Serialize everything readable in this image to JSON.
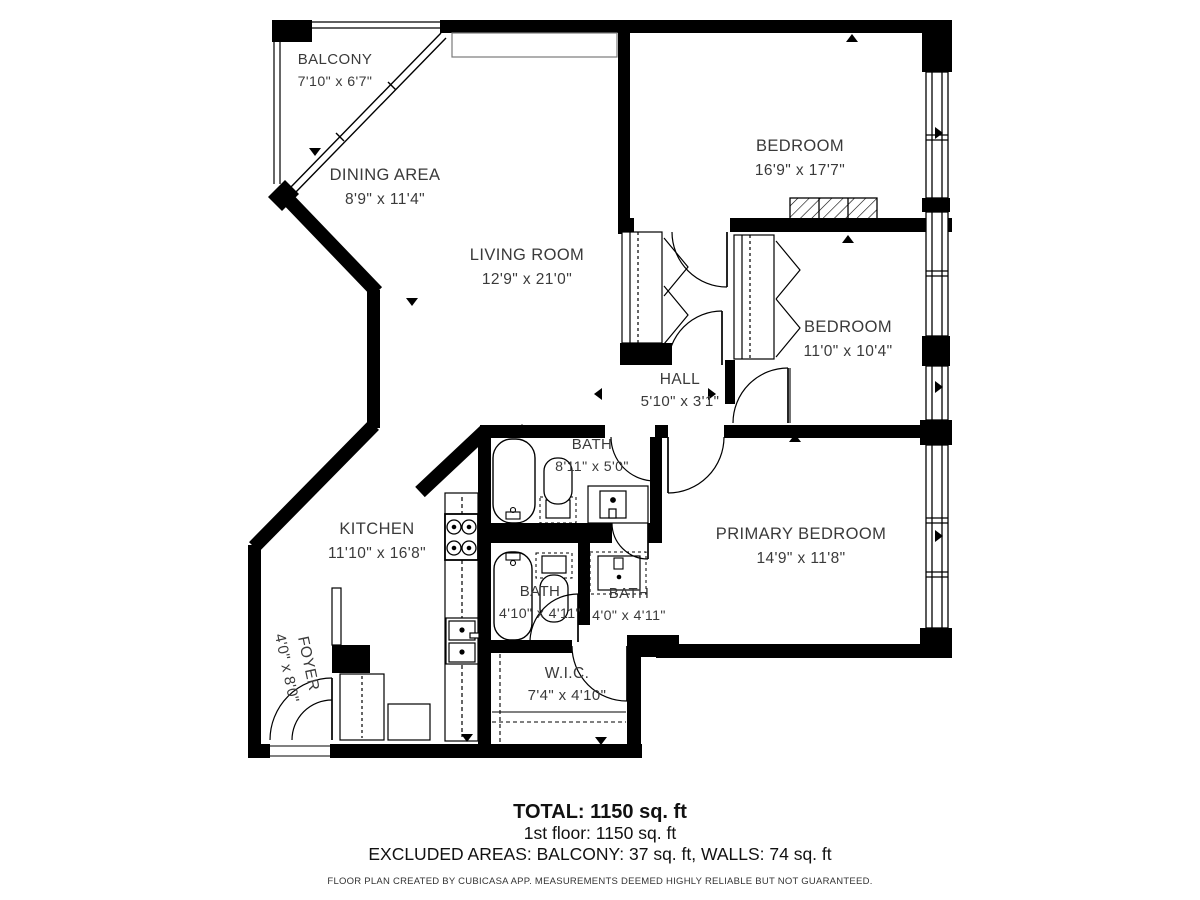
{
  "plan": {
    "rooms": [
      {
        "name": "BALCONY",
        "dims": "7'10\" x 6'7\""
      },
      {
        "name": "DINING AREA",
        "dims": "8'9\" x 11'4\""
      },
      {
        "name": "LIVING ROOM",
        "dims": "12'9\" x 21'0\""
      },
      {
        "name": "BEDROOM",
        "dims": "16'9\" x 17'7\""
      },
      {
        "name": "BEDROOM",
        "dims": "11'0\" x 10'4\""
      },
      {
        "name": "HALL",
        "dims": "5'10\" x 3'1\""
      },
      {
        "name": "BATH",
        "dims": "8'11\" x 5'0\""
      },
      {
        "name": "KITCHEN",
        "dims": "11'10\" x 16'8\""
      },
      {
        "name": "PRIMARY BEDROOM",
        "dims": "14'9\" x 11'8\""
      },
      {
        "name": "BATH",
        "dims": "4'10\" x 4'11\""
      },
      {
        "name": "BATH",
        "dims": "4'0\" x 4'11\""
      },
      {
        "name": "W.I.C.",
        "dims": "7'4\" x 4'10\""
      },
      {
        "name": "FOYER",
        "dims": "4'0\" x 8'0\""
      }
    ],
    "summary": {
      "total": "TOTAL: 1150 sq. ft",
      "floor": "1st floor: 1150 sq. ft",
      "excluded": "EXCLUDED AREAS: BALCONY: 37 sq. ft, WALLS: 74 sq. ft",
      "disclaimer": "FLOOR PLAN CREATED BY CUBICASA APP. MEASUREMENTS DEEMED HIGHLY RELIABLE BUT NOT GUARANTEED."
    },
    "colors": {
      "wall": "#000000",
      "label": "#3a3a3a",
      "background": "#ffffff"
    }
  }
}
